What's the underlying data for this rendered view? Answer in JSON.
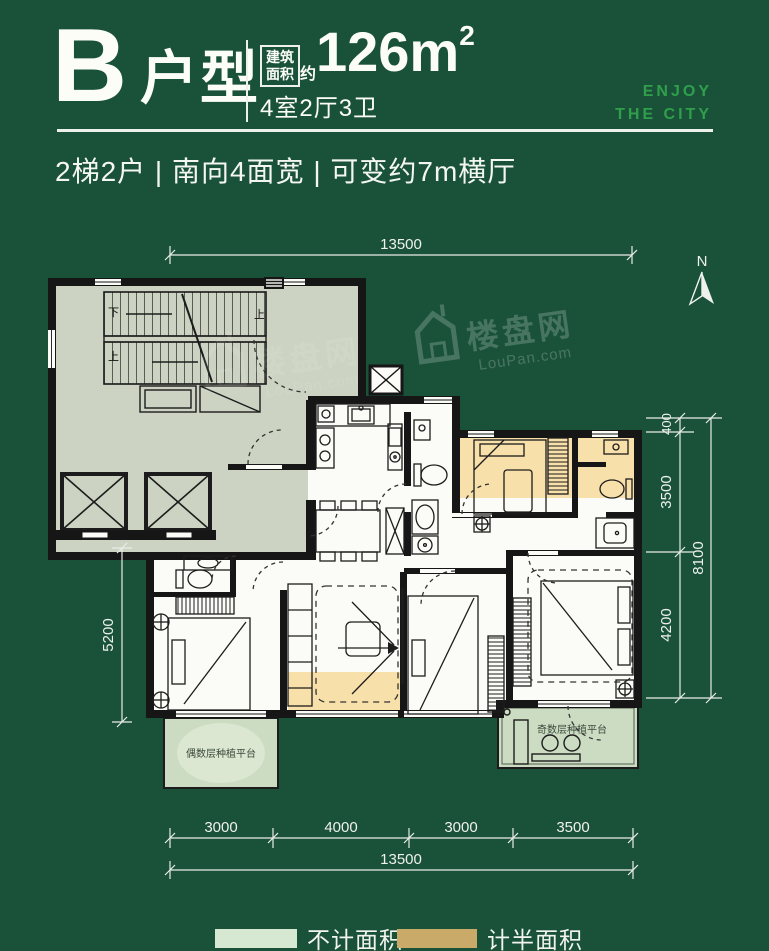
{
  "header": {
    "unit_letter": "B",
    "unit_type": "户型",
    "area_box_line1": "建筑",
    "area_box_line2": "面积",
    "area_approx": "约",
    "area_value": "126m",
    "area_exponent": "2",
    "layout_text": "4室2厅3卫",
    "slogan_line1": "ENJOY",
    "slogan_line2": "THE CITY"
  },
  "tagline": "2梯2户 | 南向4面宽 | 可变约7m横厅",
  "compass": {
    "label": "N"
  },
  "floor_plan": {
    "stairs": {
      "down": "下",
      "up": "上"
    },
    "platform_left_label": "偶数层种植平台",
    "platform_right_label": "奇数层种植平台"
  },
  "dimensions": {
    "top_total": "13500",
    "left": "5200",
    "right_segments": [
      "400",
      "3500",
      "4200"
    ],
    "right_total": "8100",
    "bottom_segments": [
      "3000",
      "4000",
      "3000",
      "3500"
    ],
    "bottom_total": "13500"
  },
  "watermark": {
    "brand": "楼盘网",
    "site": "LouPan.com"
  },
  "legend": [
    {
      "label": "不计面积",
      "color": "#d6e8d1"
    },
    {
      "label": "计半面积",
      "color": "#c9aa69"
    }
  ],
  "palette": {
    "background": "#1a5239",
    "accent_green": "#2f9f4c",
    "core_fill": "#cdd3c2",
    "room_fill": "#fbfbf7",
    "half_area_fill": "#f7e0a9",
    "no_area_fill": "#ccdcc3"
  }
}
